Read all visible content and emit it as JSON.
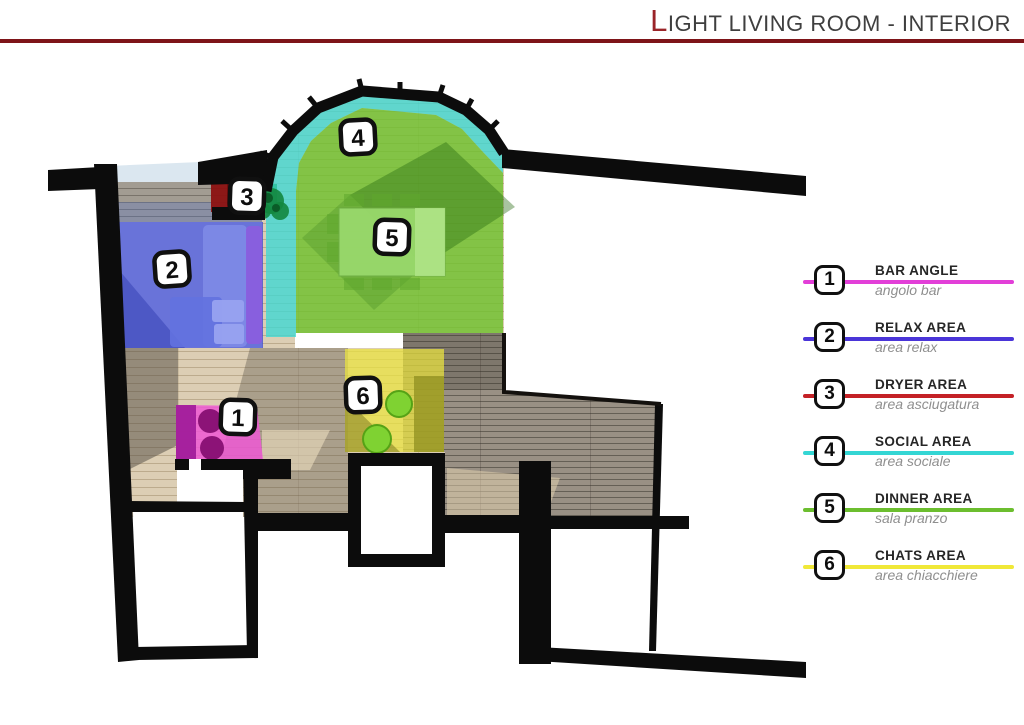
{
  "header": {
    "title_initial": "L",
    "title_rest": "IGHT LIVING ROOM - INTERIOR",
    "title_color": "#3f3f3f",
    "accent_color": "#9a2428",
    "rule_color": "#7e1418"
  },
  "legend": {
    "items": [
      {
        "num": "1",
        "label": "BAR ANGLE",
        "sublabel": "angolo bar",
        "color": "#e23fd8"
      },
      {
        "num": "2",
        "label": "RELAX AREA",
        "sublabel": "area relax",
        "color": "#4a35d8"
      },
      {
        "num": "3",
        "label": "DRYER AREA",
        "sublabel": "area asciugatura",
        "color": "#c42126"
      },
      {
        "num": "4",
        "label": "SOCIAL AREA",
        "sublabel": "area sociale",
        "color": "#34d6d4"
      },
      {
        "num": "5",
        "label": "DINNER AREA",
        "sublabel": "sala pranzo",
        "color": "#6cbe2f"
      },
      {
        "num": "6",
        "label": "CHATS AREA",
        "sublabel": "area chiacchiere",
        "color": "#f0e838"
      }
    ]
  },
  "plan": {
    "badges": [
      "1",
      "2",
      "3",
      "4",
      "5",
      "6"
    ],
    "areas": {
      "bar_angle": {
        "num": "1",
        "color": "#ef58d3"
      },
      "relax": {
        "num": "2",
        "color": "#4350cf"
      },
      "dryer": {
        "num": "3",
        "color": "#8c1111"
      },
      "social": {
        "num": "4",
        "color": "#3ed8d4"
      },
      "dinner": {
        "num": "5",
        "color": "#6fc12d"
      },
      "chats": {
        "num": "6",
        "color": "#ece43e"
      }
    }
  }
}
